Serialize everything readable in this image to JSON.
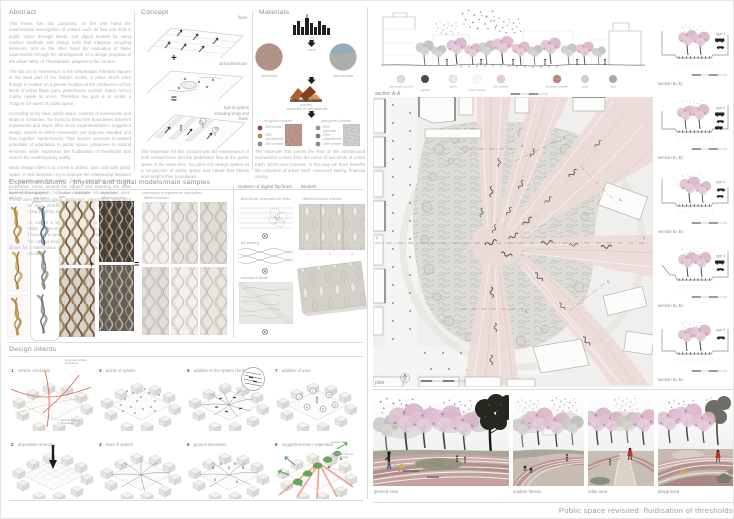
{
  "poster": {
    "footer_title": "Public space revisited: fluidisation of thresholds",
    "palette": {
      "strip_pink": "#ecdbd8",
      "blossom_pink": "#dfc2d2",
      "red_accent": "#e06a5c",
      "green_accent": "#55a24e"
    },
    "abstract": {
      "heading": "Abstract",
      "paragraphs": [
        "This thesis has two purposes: on the one hand the experimental investigation of notions such as flow and limit in public space through kinetic and digital models by using modern methods and design tools that integrate on-going elements, and on the other hand the evaluation of these experiments through the development of a design proposal at the urban fabric of Thessaloniki, adapted to the context.",
        "The site of my intervention is the Dimokratias (Vardari) Square in the west part of the historic centre, a place which even though is located on a pivotal location at the confluence of five kinds of urban flows (cars, pedestrians, cyclists, trains, metro) mainly repels its users. Therefore the goal is to create a 'magnet' for users of public space.",
        "According to my view, public space consists of movements and stops or obstacles. So, trying to blend the boundaries between movements and stops, after much experimentation I suggest a design system in which movement and stop are blended and flow together harmoniously. This system presents increased potentials of adaptation in public space, preserves its natural elements while expresses the fluidisation of thresholds that exist in the contemporary reality.",
        "Basic design intent is to create a unified, open and safe public space. In this direction I try to improve the relationship between the square and the urban fabric, supposing some new pedestrian zones around the square and lowering the main level of the square in order to incorporate into it various uses. These uses are entry plaza, auditorium, playground, relax area and fitness area, which make this space more interesting without limiting publicity and safety in the city.",
        "As a result, comes a space that is flexible and adapted in modern reality by reconciling the paths and portions of its space and security, a space that is secure and open to all, that respects the natural environment and the local society, while allows for a harmonious urban coexistence for a fluidisation of urban thresholds."
      ]
    },
    "concept": {
      "heading": "Concept",
      "label_flows": "flows",
      "label_obstacles": "obstacles/stops",
      "label_hybrid": "hybrid system including strips and flows.",
      "plus": "+",
      "equals": "=",
      "caption": "The inspiration for this concept was the maintenance of both existed trees and the pedestrian flow at the public space in the same time. So came this design system as a conjunction of public space and nature that blends and morphs their boundaries."
    },
    "materials": {
      "heading": "Materials",
      "city": "city",
      "trash": "trash",
      "used_bricks": "used bricks",
      "used_concrete": "used concrete",
      "process1": "process :",
      "process2": "production of melt materials",
      "recipe_red": {
        "name": "red gravel concrete",
        "i1": "50% bricks",
        "i2": "25% concrete mix",
        "i3": "25% cement"
      },
      "recipe_grey": {
        "name": "grey gravel concrete",
        "i1": "50% concrete",
        "i2": "25% concrete mix",
        "i3": "25% cement"
      },
      "caption": "The materials that covers the floor of this architectural intervention comes from the reuse of two kinds of urban trash: bricks and concrete. In this way we have benefits like reduction of urban trash, resources saving, financial saving."
    },
    "experiments": {
      "heading": "Experimentations - physical and digital models/main samples",
      "spaghetti_label": "..experiments with spaghetti",
      "col_raw": "..raw form",
      "col_raw_plastic": "..raw form + plastic",
      "weaving_label": "..system - weaving of lines",
      "papercuts_label": "..paper cuts",
      "versions": "..different versions",
      "combo_label": "combination of experiments: final system",
      "combo_versions": "..different versions",
      "plus": "+",
      "equals": "=",
      "digital_heading": "System of digital flip lines",
      "step1": "..lines (flows) connected over limits",
      "step2": "..line weaving",
      "step3": "..envelope of terrain",
      "models_heading": "Models",
      "models_sub": "..different versions of terrain",
      "n1": "1",
      "n2": "2",
      "n3": "3"
    },
    "design_intents": {
      "heading": "Design intents",
      "items": [
        {
          "num": "1",
          "label": "vehicle circulation"
        },
        {
          "num": "2",
          "label": "disposition of terrain"
        },
        {
          "num": "3",
          "label": "points of system"
        },
        {
          "num": "4",
          "label": "lines of system"
        },
        {
          "num": "5",
          "label": "addition to the system / kerbs"
        },
        {
          "num": "6",
          "label": "ground elevations"
        },
        {
          "num": "7",
          "label": "addition of uses"
        },
        {
          "num": "8",
          "label": "suggested trees / vegetation"
        }
      ],
      "proposed_label": "proposed vehicle circulation",
      "existed_label": "existed vehicle circulation",
      "existed_trees": "existed trees",
      "new_trees": "trees with intense visual change",
      "use_numbers": [
        "1",
        "2",
        "3",
        "4",
        "5",
        "6"
      ]
    },
    "section_aa": {
      "label": "section A-A",
      "legend": [
        {
          "label": "grey gravel concrete",
          "color": "#dcdcd9"
        },
        {
          "label": "asphalt",
          "color": "#4b4b48"
        },
        {
          "label": "gravel",
          "color": "#e9e9e6"
        },
        {
          "label": "white concrete",
          "color": "#f8f8f6"
        },
        {
          "label": "pink concrete",
          "color": "#e5cbd1"
        },
        {
          "label": "red gravel concrete",
          "color": "#c2908a"
        },
        {
          "label": "grass",
          "color": "#cfcfc9"
        },
        {
          "label": "trees",
          "color": "#a9a9a4"
        }
      ]
    },
    "plan": {
      "label": "plan",
      "marker": "A",
      "b_markers": [
        "B₁",
        "B₂",
        "B₃",
        "B₄",
        "B₅"
      ]
    },
    "b_sections": [
      {
        "label": "section B₁-B₁′",
        "type": "type 1"
      },
      {
        "label": "section B₂-B₂′",
        "type": "type 2"
      },
      {
        "label": "section B₃-B₃′",
        "type": "type 3"
      },
      {
        "label": "section B₄-B₄′",
        "type": "type 4"
      },
      {
        "label": "section B₅-B₅′",
        "type": "type 5"
      }
    ],
    "views": [
      {
        "caption": "general view"
      },
      {
        "caption": "outdoor fitness"
      },
      {
        "caption": "relax area"
      },
      {
        "caption": "playground"
      }
    ]
  }
}
